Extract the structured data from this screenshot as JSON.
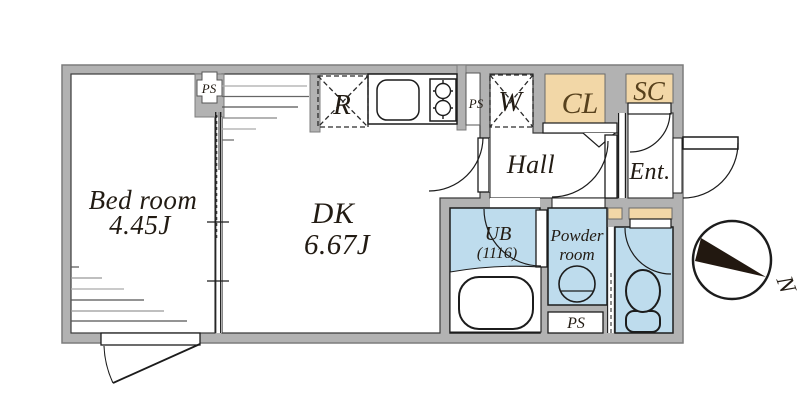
{
  "page": {
    "type": "apartment floor plan"
  },
  "colors": {
    "wall": "#b2b2b2",
    "wall_edge": "#7c7c7c",
    "floor": "#ffffff",
    "water": "#bedced",
    "storage": "#f2d7a7",
    "storage_edge": "#6b6b6b",
    "line": "#1c1c1c",
    "text": "#221b13",
    "storage_text": "#57411d",
    "needle": "#221810",
    "panel": "#999999"
  },
  "rooms": {
    "bedroom": {
      "name": "Bed room",
      "size": "4.45J"
    },
    "dining_kitchen": {
      "name": "DK",
      "size": "6.67J"
    },
    "hall": {
      "name": "Hall"
    },
    "entrance": {
      "name": "Ent."
    },
    "closet": {
      "name": "CL"
    },
    "shoe_closet": {
      "name": "SC"
    },
    "unit_bath": {
      "name": "UB",
      "size": "(1116)"
    },
    "powder_room": {
      "line1": "Powder",
      "line2": "room"
    }
  },
  "labels": {
    "pipe_space_bedroom": "PS",
    "pipe_space_kitchen": "PS",
    "pipe_space_lower": "PS",
    "refrigerator": "R",
    "washer": "W",
    "compass_north": "N"
  }
}
